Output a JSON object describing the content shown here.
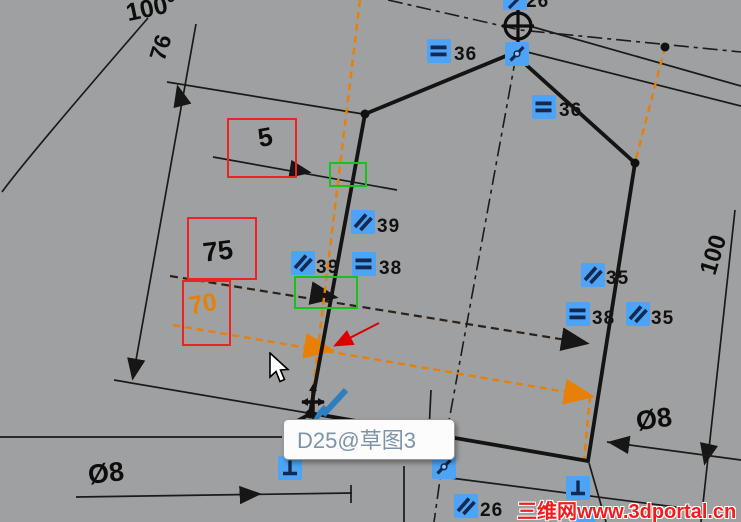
{
  "app": {
    "description": "CAD sketch editing viewport with dimension being dragged"
  },
  "tooltip": {
    "text": "D25@草图3"
  },
  "watermark": {
    "text": "三维网www.3dportal.cn"
  },
  "dimensions": {
    "angle": "100°",
    "d76": "76",
    "d5": "5",
    "d75": "75",
    "d70": "70",
    "d100": "100",
    "dia_left": "Ø8",
    "dia_right": "Ø8"
  },
  "badges": [
    {
      "type": "equal",
      "label": "36"
    },
    {
      "type": "equal",
      "label": "36"
    },
    {
      "type": "parallel",
      "label": "39"
    },
    {
      "type": "parallel",
      "label": "39"
    },
    {
      "type": "equal",
      "label": "38"
    },
    {
      "type": "parallel",
      "label": "35"
    },
    {
      "type": "equal",
      "label": "38"
    },
    {
      "type": "parallel",
      "label": "35"
    },
    {
      "type": "parallel",
      "label": "26"
    },
    {
      "type": "perpendicular",
      "label": ""
    },
    {
      "type": "coincident",
      "label": ""
    },
    {
      "type": "perpendicular",
      "label": ""
    },
    {
      "type": "coincident",
      "label": ""
    },
    {
      "type": "clipped",
      "label": "26"
    }
  ],
  "icons": {
    "equal": "double-horizontal-bars",
    "parallel": "double-diagonal-bars",
    "perpendicular": "perpendicular-tee",
    "coincident": "slash-with-dot",
    "origin": "crosshair-circle",
    "cursor": "white-arrow-pointer",
    "drag": "move-cross-with-blue-diagonals"
  },
  "colors": {
    "bg": "#9fa0a1",
    "ink": "#161616",
    "badge-blue": "#4da3f5",
    "badge-glyph": "#13294f",
    "accent-orange": "#e87f06",
    "box-red": "#ee2222",
    "box-green": "#17c21b",
    "annotation-red": "#dd0000",
    "watermark-red": "#f21c1c",
    "tooltip-text": "#7d93a8"
  }
}
